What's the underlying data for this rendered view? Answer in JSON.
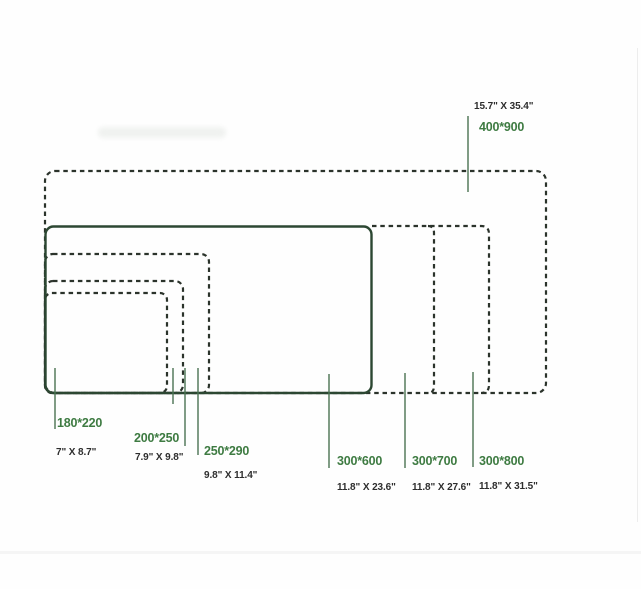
{
  "pads": [
    {
      "mm": "180*220",
      "inches": "7\" X 8.7\""
    },
    {
      "mm": "200*250",
      "inches": "7.9\" X 9.8\""
    },
    {
      "mm": "250*290",
      "inches": "9.8\" X 11.4\""
    },
    {
      "mm": "300*600",
      "inches": "11.8\" X 23.6\""
    },
    {
      "mm": "300*700",
      "inches": "11.8\" X 27.6\""
    },
    {
      "mm": "300*800",
      "inches": "11.8\" X 31.5\""
    },
    {
      "mm": "400*900",
      "inches": "15.7\" X 35.4\""
    }
  ],
  "colors": {
    "size_label_green": "#3e7b42",
    "inch_label_dark": "#2d2d2d",
    "dashed_outline": "#2b332b",
    "solid_outline": "#2c4732",
    "leader_line": "#4a7352",
    "background": "#fefefe"
  }
}
